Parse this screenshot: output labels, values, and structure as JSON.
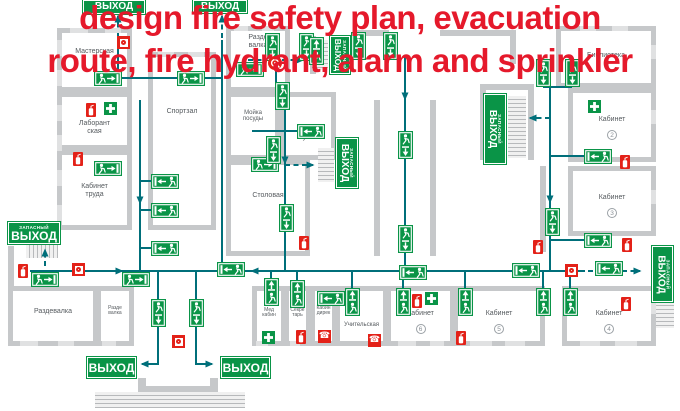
{
  "title": {
    "line1": "design fire safety plan, evacuation",
    "line2": "route, fire hydrant, alarm and sprinkler"
  },
  "colors": {
    "sign_green": "#0a9447",
    "route_teal": "#006f7a",
    "wall_gray": "#c6c8ca",
    "window_gray": "#e0e1e2",
    "safety_red": "#e32118",
    "title_red": "#e5192b",
    "label_gray": "#555a5e"
  },
  "rooms": [
    {
      "label": "Мастерская",
      "x": 57,
      "y": 28,
      "w": 75,
      "h": 64,
      "ly": 48
    },
    {
      "label": "Спортзал",
      "x": 148,
      "y": 52,
      "w": 68,
      "h": 178,
      "ly": 108
    },
    {
      "label": "Лаборант\nская",
      "x": 57,
      "y": 92,
      "w": 75,
      "h": 58,
      "ly": 120
    },
    {
      "label": "Кабинет\nтруда",
      "x": 57,
      "y": 150,
      "w": 75,
      "h": 80,
      "ly": 183
    },
    {
      "label": "Разде\nвалка",
      "x": 226,
      "y": 26,
      "w": 64,
      "h": 66,
      "ly": 34
    },
    {
      "label": "Мойка\nпосуды",
      "x": 226,
      "y": 92,
      "w": 54,
      "h": 68,
      "ly": 110,
      "fs": 6
    },
    {
      "label": "Кухня",
      "x": 280,
      "y": 92,
      "w": 56,
      "h": 68,
      "ly": 134
    },
    {
      "label": "Столовая",
      "x": 226,
      "y": 160,
      "w": 84,
      "h": 96,
      "ly": 192
    },
    {
      "label": "Библиотека",
      "x": 556,
      "y": 26,
      "w": 100,
      "h": 62,
      "ly": 52
    },
    {
      "label": "Кабинет",
      "num": "2",
      "x": 568,
      "y": 88,
      "w": 88,
      "h": 74,
      "ly": 116
    },
    {
      "label": "Кабинет",
      "num": "3",
      "x": 568,
      "y": 166,
      "w": 88,
      "h": 70,
      "ly": 194
    },
    {
      "label": "Кабинет",
      "num": "4",
      "x": 562,
      "y": 286,
      "w": 94,
      "h": 60,
      "ly": 310
    },
    {
      "label": "Кабинет",
      "num": "5",
      "x": 453,
      "y": 286,
      "w": 92,
      "h": 60,
      "ly": 310
    },
    {
      "label": "Кабинет",
      "num": "6",
      "x": 386,
      "y": 286,
      "w": 69,
      "h": 60,
      "ly": 310
    },
    {
      "label": "Учительская",
      "x": 335,
      "y": 286,
      "w": 53,
      "h": 60,
      "ly": 322,
      "fs": 6
    },
    {
      "label": "Кабин\nдирек",
      "x": 310,
      "y": 286,
      "w": 27,
      "h": 60,
      "ly": 306,
      "fs": 5
    },
    {
      "label": "Секре\nтарь",
      "x": 284,
      "y": 286,
      "w": 27,
      "h": 60,
      "ly": 308,
      "fs": 5
    },
    {
      "label": "Мед\nкабин",
      "x": 252,
      "y": 286,
      "w": 34,
      "h": 60,
      "ly": 308,
      "fs": 5
    },
    {
      "label": "Раздевалка",
      "x": 8,
      "y": 286,
      "w": 90,
      "h": 60,
      "ly": 308
    },
    {
      "label": "Разде\nвалка",
      "x": 96,
      "y": 286,
      "w": 38,
      "h": 60,
      "ly": 306,
      "fs": 5
    }
  ],
  "walls": [
    {
      "x": 8,
      "y": 246,
      "w": 6,
      "h": 42
    },
    {
      "x": 374,
      "y": 100,
      "w": 6,
      "h": 156
    },
    {
      "x": 430,
      "y": 100,
      "w": 6,
      "h": 156
    },
    {
      "x": 480,
      "y": 84,
      "w": 6,
      "h": 76
    },
    {
      "x": 528,
      "y": 84,
      "w": 6,
      "h": 76
    },
    {
      "x": 480,
      "y": 84,
      "w": 54,
      "h": 6
    },
    {
      "x": 540,
      "y": 166,
      "w": 6,
      "h": 86
    },
    {
      "x": 355,
      "y": 30,
      "w": 34,
      "h": 6
    },
    {
      "x": 440,
      "y": 30,
      "w": 76,
      "h": 6
    },
    {
      "x": 510,
      "y": 30,
      "w": 6,
      "h": 34
    },
    {
      "x": 310,
      "y": 36,
      "w": 6,
      "h": 38
    },
    {
      "x": 336,
      "y": 144,
      "w": 6,
      "h": 44
    },
    {
      "x": 138,
      "y": 378,
      "w": 8,
      "h": 14
    },
    {
      "x": 210,
      "y": 378,
      "w": 8,
      "h": 14
    },
    {
      "x": 138,
      "y": 386,
      "w": 80,
      "h": 6
    }
  ],
  "windows": [
    {
      "x": 57,
      "y": 40,
      "w": 5,
      "h": 16
    },
    {
      "x": 57,
      "y": 70,
      "w": 5,
      "h": 16
    },
    {
      "x": 57,
      "y": 105,
      "w": 5,
      "h": 16
    },
    {
      "x": 57,
      "y": 135,
      "w": 5,
      "h": 16
    },
    {
      "x": 57,
      "y": 170,
      "w": 5,
      "h": 16
    },
    {
      "x": 57,
      "y": 205,
      "w": 5,
      "h": 16
    },
    {
      "x": 70,
      "y": 28,
      "w": 18,
      "h": 5
    },
    {
      "x": 105,
      "y": 28,
      "w": 16,
      "h": 5
    },
    {
      "x": 234,
      "y": 26,
      "w": 14,
      "h": 5
    },
    {
      "x": 262,
      "y": 26,
      "w": 12,
      "h": 5
    },
    {
      "x": 580,
      "y": 26,
      "w": 16,
      "h": 5
    },
    {
      "x": 612,
      "y": 26,
      "w": 16,
      "h": 5
    },
    {
      "x": 158,
      "y": 52,
      "w": 16,
      "h": 5
    },
    {
      "x": 188,
      "y": 52,
      "w": 16,
      "h": 5
    },
    {
      "x": 20,
      "y": 341,
      "w": 18,
      "h": 5
    },
    {
      "x": 58,
      "y": 341,
      "w": 16,
      "h": 5
    },
    {
      "x": 102,
      "y": 341,
      "w": 14,
      "h": 5
    },
    {
      "x": 256,
      "y": 341,
      "w": 12,
      "h": 5
    },
    {
      "x": 290,
      "y": 341,
      "w": 10,
      "h": 5
    },
    {
      "x": 398,
      "y": 341,
      "w": 18,
      "h": 5
    },
    {
      "x": 430,
      "y": 341,
      "w": 14,
      "h": 5
    },
    {
      "x": 470,
      "y": 341,
      "w": 22,
      "h": 5
    },
    {
      "x": 505,
      "y": 341,
      "w": 20,
      "h": 5
    },
    {
      "x": 580,
      "y": 341,
      "w": 20,
      "h": 5
    },
    {
      "x": 615,
      "y": 341,
      "w": 22,
      "h": 5
    },
    {
      "x": 651,
      "y": 45,
      "w": 5,
      "h": 14
    },
    {
      "x": 651,
      "y": 110,
      "w": 5,
      "h": 14
    },
    {
      "x": 651,
      "y": 190,
      "w": 5,
      "h": 14
    },
    {
      "x": 651,
      "y": 300,
      "w": 5,
      "h": 14
    }
  ],
  "stairs": [
    {
      "x": 26,
      "y": 245,
      "w": 32,
      "h": 13,
      "dir": "v"
    },
    {
      "x": 312,
      "y": 40,
      "w": 16,
      "h": 30,
      "dir": "h"
    },
    {
      "x": 318,
      "y": 148,
      "w": 16,
      "h": 34,
      "dir": "h"
    },
    {
      "x": 508,
      "y": 96,
      "w": 18,
      "h": 62,
      "dir": "h"
    },
    {
      "x": 656,
      "y": 302,
      "w": 18,
      "h": 26,
      "dir": "h"
    },
    {
      "x": 95,
      "y": 392,
      "w": 150,
      "h": 16,
      "dir": "h"
    }
  ],
  "exit_signs": [
    {
      "t": "ВЫХОД",
      "x": 83,
      "y": 0,
      "w": 62,
      "h": 14
    },
    {
      "t": "ВЫХОД",
      "x": 193,
      "y": 0,
      "w": 54,
      "h": 13
    },
    {
      "t": "ВЫХОД",
      "s": "ЗАПАСНЫЙ",
      "x": 8,
      "y": 222,
      "w": 52,
      "h": 22
    },
    {
      "t": "ВЫХОД",
      "x": 87,
      "y": 357,
      "w": 49,
      "h": 21
    },
    {
      "t": "ВЫХОД",
      "x": 221,
      "y": 357,
      "w": 49,
      "h": 21
    },
    {
      "t": "ВЫХОД",
      "s": "ЗАПАСНЫЙ",
      "x": 330,
      "y": 36,
      "w": 20,
      "h": 38,
      "v": 1
    },
    {
      "t": "ВЫХОД",
      "s": "ЗАПАСНЫЙ",
      "x": 336,
      "y": 138,
      "w": 22,
      "h": 50,
      "v": 1
    },
    {
      "t": "ВЫХОД",
      "s": "ЗАПАСНЫЙ",
      "x": 484,
      "y": 94,
      "w": 22,
      "h": 70,
      "v": 1
    },
    {
      "t": "ВЫХОД",
      "s": "ЗАПАСНЫЙ",
      "x": 652,
      "y": 246,
      "w": 21,
      "h": 56,
      "v": 1
    }
  ],
  "route_boards": [
    {
      "k": "mr",
      "x": 95,
      "y": 72
    },
    {
      "k": "mr",
      "x": 178,
      "y": 72
    },
    {
      "k": "mr",
      "x": 237,
      "y": 63
    },
    {
      "k": "mr",
      "x": 95,
      "y": 162
    },
    {
      "k": "mr",
      "x": 252,
      "y": 158
    },
    {
      "k": "mr",
      "x": 32,
      "y": 273
    },
    {
      "k": "mr",
      "x": 123,
      "y": 273
    },
    {
      "k": "ml",
      "x": 152,
      "y": 175
    },
    {
      "k": "ml",
      "x": 152,
      "y": 204
    },
    {
      "k": "ml",
      "x": 152,
      "y": 242
    },
    {
      "k": "ml",
      "x": 298,
      "y": 125
    },
    {
      "k": "ml",
      "x": 318,
      "y": 292
    },
    {
      "k": "ml",
      "x": 218,
      "y": 263
    },
    {
      "k": "ml",
      "x": 400,
      "y": 266
    },
    {
      "k": "ml",
      "x": 513,
      "y": 264
    },
    {
      "k": "ml",
      "x": 596,
      "y": 262
    },
    {
      "k": "ml",
      "x": 585,
      "y": 150
    },
    {
      "k": "ml",
      "x": 585,
      "y": 234
    },
    {
      "k": "md",
      "x": 266,
      "y": 34
    },
    {
      "k": "md",
      "x": 300,
      "y": 34
    },
    {
      "k": "md",
      "x": 352,
      "y": 33
    },
    {
      "k": "md",
      "x": 384,
      "y": 33
    },
    {
      "k": "md",
      "x": 537,
      "y": 60
    },
    {
      "k": "md",
      "x": 566,
      "y": 60
    },
    {
      "k": "md",
      "x": 276,
      "y": 83
    },
    {
      "k": "md",
      "x": 267,
      "y": 137
    },
    {
      "k": "md",
      "x": 280,
      "y": 205
    },
    {
      "k": "md",
      "x": 399,
      "y": 132
    },
    {
      "k": "md",
      "x": 399,
      "y": 226
    },
    {
      "k": "md",
      "x": 546,
      "y": 209
    },
    {
      "k": "md",
      "x": 152,
      "y": 300
    },
    {
      "k": "md",
      "x": 190,
      "y": 300
    },
    {
      "k": "mu",
      "x": 310,
      "y": 38
    },
    {
      "k": "mu",
      "x": 265,
      "y": 279
    },
    {
      "k": "mu",
      "x": 291,
      "y": 281
    },
    {
      "k": "mu",
      "x": 346,
      "y": 289
    },
    {
      "k": "mu",
      "x": 397,
      "y": 289
    },
    {
      "k": "mu",
      "x": 459,
      "y": 289
    },
    {
      "k": "mu",
      "x": 537,
      "y": 289
    },
    {
      "k": "mu",
      "x": 564,
      "y": 289
    }
  ],
  "safety_icons": [
    {
      "type": "extinguisher",
      "x": 86,
      "y": 103
    },
    {
      "type": "extinguisher",
      "x": 73,
      "y": 152
    },
    {
      "type": "extinguisher",
      "x": 18,
      "y": 264
    },
    {
      "type": "extinguisher",
      "x": 299,
      "y": 236
    },
    {
      "type": "extinguisher",
      "x": 296,
      "y": 330
    },
    {
      "type": "extinguisher",
      "x": 412,
      "y": 294
    },
    {
      "type": "extinguisher",
      "x": 456,
      "y": 331
    },
    {
      "type": "extinguisher",
      "x": 621,
      "y": 297
    },
    {
      "type": "extinguisher",
      "x": 620,
      "y": 155
    },
    {
      "type": "extinguisher",
      "x": 622,
      "y": 238
    },
    {
      "type": "extinguisher",
      "x": 533,
      "y": 240
    },
    {
      "type": "alarm",
      "x": 117,
      "y": 36
    },
    {
      "type": "alarm",
      "x": 72,
      "y": 263
    },
    {
      "type": "alarm",
      "x": 172,
      "y": 335
    },
    {
      "type": "alarm",
      "x": 565,
      "y": 264
    },
    {
      "type": "phone",
      "x": 318,
      "y": 330
    },
    {
      "type": "phone",
      "x": 368,
      "y": 334
    },
    {
      "type": "firstaid",
      "x": 104,
      "y": 102
    },
    {
      "type": "firstaid",
      "x": 588,
      "y": 100
    },
    {
      "type": "firstaid",
      "x": 425,
      "y": 292
    },
    {
      "type": "firstaid",
      "x": 262,
      "y": 331
    },
    {
      "type": "hydrant",
      "x": 268,
      "y": 56
    }
  ],
  "routes": [
    {
      "p": [
        [
          30,
          271
        ],
        [
          122,
          271
        ]
      ],
      "a": 1
    },
    {
      "p": [
        [
          122,
          271
        ],
        [
          585,
          271
        ]
      ]
    },
    {
      "p": [
        [
          340,
          271
        ],
        [
          252,
          271
        ]
      ],
      "a": 1
    },
    {
      "p": [
        [
          588,
          271
        ],
        [
          640,
          271
        ]
      ],
      "d": 1,
      "a": 1
    },
    {
      "p": [
        [
          118,
          36
        ],
        [
          118,
          78
        ]
      ]
    },
    {
      "p": [
        [
          118,
          36
        ],
        [
          118,
          16
        ]
      ],
      "d": 1,
      "a": 1
    },
    {
      "p": [
        [
          99,
          78
        ],
        [
          222,
          78
        ]
      ]
    },
    {
      "p": [
        [
          222,
          40
        ],
        [
          222,
          271
        ]
      ]
    },
    {
      "p": [
        [
          222,
          38
        ],
        [
          222,
          16
        ]
      ],
      "d": 1,
      "a": 1
    },
    {
      "p": [
        [
          140,
          100
        ],
        [
          140,
          271
        ]
      ]
    },
    {
      "p": [
        [
          140,
          188
        ],
        [
          140,
          203
        ]
      ],
      "a": 1
    },
    {
      "p": [
        [
          152,
          181
        ],
        [
          140,
          181
        ]
      ]
    },
    {
      "p": [
        [
          152,
          210
        ],
        [
          140,
          210
        ]
      ]
    },
    {
      "p": [
        [
          152,
          248
        ],
        [
          140,
          248
        ]
      ]
    },
    {
      "p": [
        [
          285,
          95
        ],
        [
          285,
          271
        ]
      ]
    },
    {
      "p": [
        [
          285,
          150
        ],
        [
          285,
          163
        ]
      ],
      "a": 1
    },
    {
      "p": [
        [
          285,
          165
        ],
        [
          313,
          165
        ]
      ],
      "d": 1,
      "a": 1
    },
    {
      "p": [
        [
          252,
          131
        ],
        [
          298,
          131
        ]
      ]
    },
    {
      "p": [
        [
          276,
          48
        ],
        [
          276,
          83
        ]
      ]
    },
    {
      "p": [
        [
          248,
          60
        ],
        [
          303,
          60
        ]
      ],
      "d": 1,
      "a": 1
    },
    {
      "p": [
        [
          405,
          55
        ],
        [
          405,
          271
        ]
      ]
    },
    {
      "p": [
        [
          405,
          85
        ],
        [
          405,
          99
        ]
      ],
      "a": 1
    },
    {
      "p": [
        [
          550,
          87
        ],
        [
          550,
          271
        ]
      ]
    },
    {
      "p": [
        [
          550,
          188
        ],
        [
          550,
          202
        ]
      ],
      "a": 1
    },
    {
      "p": [
        [
          543,
          87
        ],
        [
          572,
          87
        ]
      ]
    },
    {
      "p": [
        [
          585,
          156
        ],
        [
          550,
          156
        ]
      ]
    },
    {
      "p": [
        [
          585,
          240
        ],
        [
          550,
          240
        ]
      ]
    },
    {
      "p": [
        [
          550,
          118
        ],
        [
          530,
          118
        ]
      ],
      "d": 1,
      "a": 1
    },
    {
      "p": [
        [
          45,
          266
        ],
        [
          45,
          250
        ]
      ],
      "d": 1,
      "a": 1
    },
    {
      "p": [
        [
          158,
          271
        ],
        [
          158,
          364
        ],
        [
          142,
          364
        ]
      ],
      "a": 1
    },
    {
      "p": [
        [
          196,
          271
        ],
        [
          196,
          364
        ],
        [
          212,
          364
        ]
      ],
      "a": 1
    },
    {
      "p": [
        [
          271,
          271
        ],
        [
          271,
          281
        ]
      ]
    },
    {
      "p": [
        [
          297,
          271
        ],
        [
          297,
          283
        ]
      ]
    },
    {
      "p": [
        [
          352,
          271
        ],
        [
          352,
          290
        ]
      ]
    },
    {
      "p": [
        [
          403,
          271
        ],
        [
          403,
          290
        ]
      ]
    },
    {
      "p": [
        [
          465,
          271
        ],
        [
          465,
          290
        ]
      ]
    },
    {
      "p": [
        [
          543,
          271
        ],
        [
          543,
          290
        ]
      ]
    },
    {
      "p": [
        [
          570,
          271
        ],
        [
          570,
          290
        ]
      ]
    }
  ]
}
